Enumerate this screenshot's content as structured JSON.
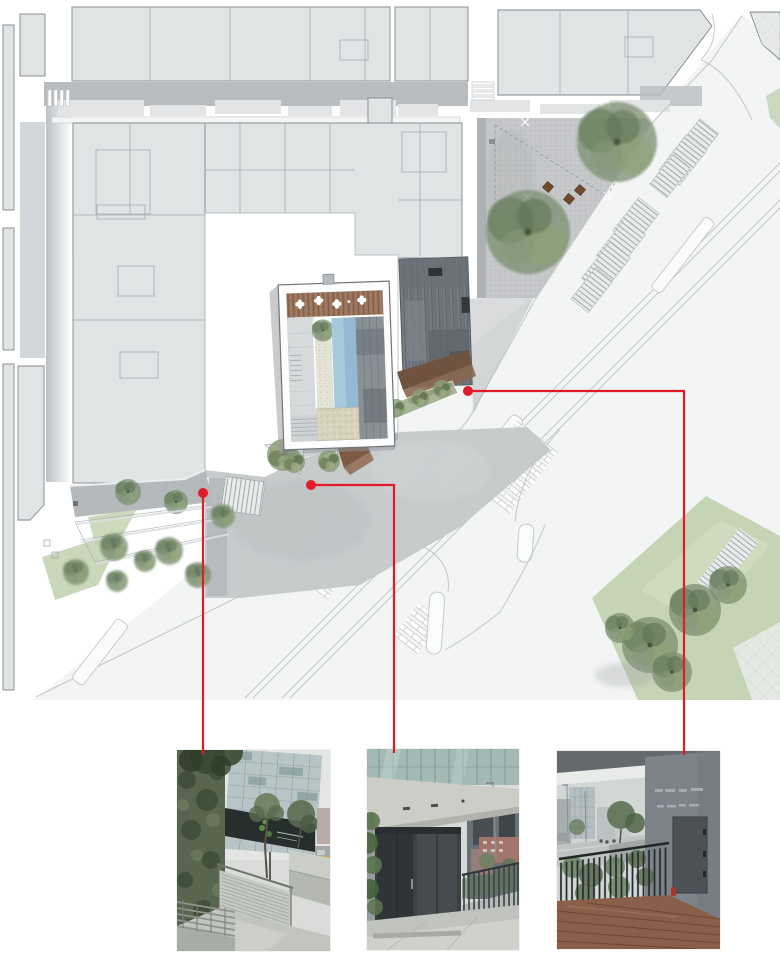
{
  "page": {
    "width": 780,
    "height": 968,
    "background": "#ffffff",
    "description": "architectural site plan with three red callouts linking plan entrances to street photographs"
  },
  "palette": {
    "accent_red": "#e21b2b",
    "block_fill": "#e1e4e5",
    "block_border": "#82888c",
    "street_shadow": "#b9bdc0",
    "plaza_paving": "#c6c8ca",
    "entry_plaza": "#c5c8c9",
    "dark_roof": "#757c82",
    "rust_band": "#6f5340",
    "wood_deck": "#96715a",
    "pool_blue": "#a6c9dc",
    "gravel": "#d9d3bd",
    "tree_green": "#7b8f70",
    "lawn_green": "#c0d0ae"
  },
  "site_plan": {
    "name": "site-plan-drawing",
    "callouts": [
      {
        "id": "callout-1",
        "dot": {
          "x": 203,
          "y": 493
        },
        "points": "203,493 203,754",
        "target": "photo-1"
      },
      {
        "id": "callout-2",
        "dot": {
          "x": 311,
          "y": 485
        },
        "points": "311,485 394,485 394,753",
        "target": "photo-2"
      },
      {
        "id": "callout-3",
        "dot": {
          "x": 468,
          "y": 391
        },
        "points": "468,391 684,391 684,755",
        "target": "photo-3"
      }
    ]
  },
  "photos": [
    {
      "id": "photo-1",
      "name": "photo-street-stairs-ivy",
      "x": 177,
      "y": 750,
      "width": 153,
      "height": 201
    },
    {
      "id": "photo-2",
      "name": "photo-entrance-under-canopy",
      "x": 367,
      "y": 749,
      "width": 152,
      "height": 201
    },
    {
      "id": "photo-3",
      "name": "photo-fence-wood-deck-entrance",
      "x": 557,
      "y": 751,
      "width": 163,
      "height": 198
    }
  ]
}
